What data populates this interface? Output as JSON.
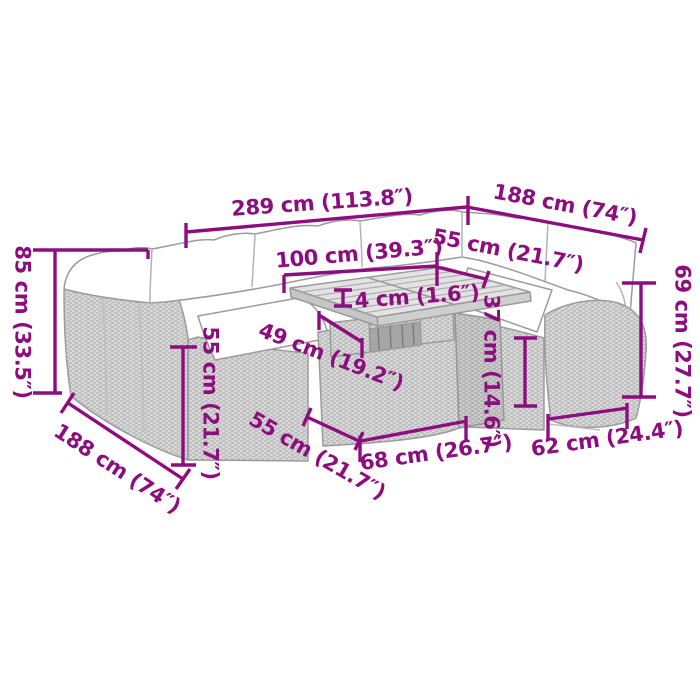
{
  "diagram": {
    "type": "product-dimension-diagram",
    "subject": "garden lounge sofa set with cushions and coffee table (line-art sketch)",
    "background_color": "#ffffff",
    "dimension_color": "#8d0d7f",
    "sketch_stroke_color": "#9b9b9b"
  },
  "dimensions": {
    "dim_289": {
      "cm": 289,
      "in": 113.8,
      "label": "289 cm (113.8″)"
    },
    "dim_188_top": {
      "cm": 188,
      "in": 74,
      "label": "188 cm (74″)"
    },
    "dim_85_left": {
      "cm": 85,
      "in": 33.5,
      "label": "85 cm (33.5″)"
    },
    "dim_100": {
      "cm": 100,
      "in": 39.3,
      "label": "100 cm (39.3″)"
    },
    "dim_55_top": {
      "cm": 55,
      "in": 21.7,
      "label": "55 cm (21.7″)"
    },
    "dim_4": {
      "cm": 4,
      "in": 1.6,
      "label": "4 cm (1.6″)"
    },
    "dim_37": {
      "cm": 37,
      "in": 14.6,
      "label": "37 cm (14.6″)"
    },
    "dim_69_right": {
      "cm": 69,
      "in": 27.7,
      "label": "69 cm (27.7″)"
    },
    "dim_55_left": {
      "cm": 55,
      "in": 21.7,
      "label": "55 cm (21.7″)"
    },
    "dim_188_bottom": {
      "cm": 188,
      "in": 74,
      "label": "188 cm (74″)"
    },
    "dim_55_bottom": {
      "cm": 55,
      "in": 21.7,
      "label": "55 cm (21.7″)"
    },
    "dim_68": {
      "cm": 68,
      "in": 26.7,
      "label": "68 cm (26.7″)"
    },
    "dim_62": {
      "cm": 62,
      "in": 24.4,
      "label": "62 cm (24.4″)"
    },
    "dim_49": {
      "cm": 49,
      "in": 19.2,
      "label": "49 cm (19.2″)"
    }
  }
}
